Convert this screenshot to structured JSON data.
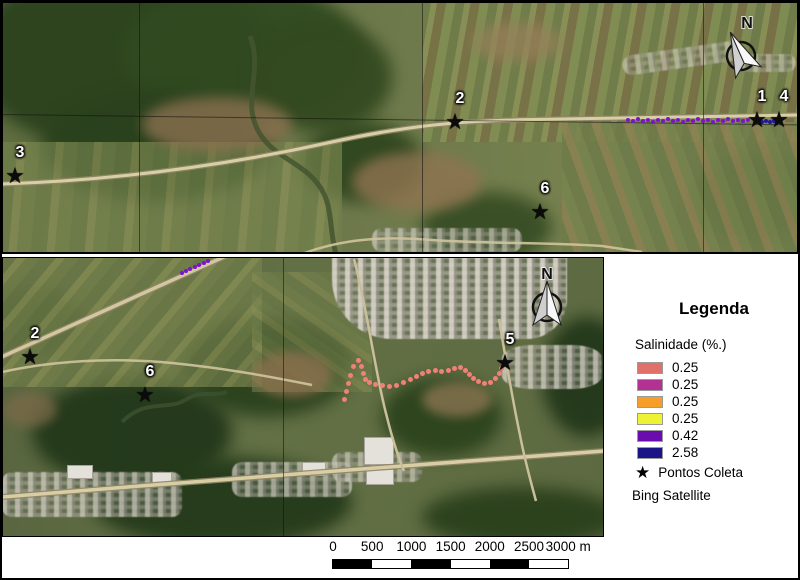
{
  "legend": {
    "title": "Legenda",
    "layer_title": "Salinidade (%.)",
    "classes": [
      {
        "color": "#e0706a",
        "label": "0.25"
      },
      {
        "color": "#b23192",
        "label": "0.25"
      },
      {
        "color": "#f59e29",
        "label": "0.25"
      },
      {
        "color": "#edf232",
        "label": "0.25"
      },
      {
        "color": "#6b0cae",
        "label": "0.42"
      },
      {
        "color": "#1a1487",
        "label": "2.58"
      }
    ],
    "points_symbol": "★",
    "points_label": "Pontos Coleta",
    "basemap_label": "Bing Satellite"
  },
  "north_arrow_label": "N",
  "scalebar": {
    "labels": [
      "0",
      "500",
      "1000",
      "1500",
      "2000",
      "2500",
      "3000 m"
    ],
    "segment_px": 39.2,
    "segment_colors": [
      "#000000",
      "#ffffff",
      "#000000",
      "#ffffff",
      "#000000",
      "#ffffff"
    ]
  },
  "maps": [
    {
      "name": "overview-map",
      "stations": [
        {
          "label": "3",
          "x": 13,
          "y": 174
        },
        {
          "label": "2",
          "x": 453,
          "y": 120
        },
        {
          "label": "6",
          "x": 538,
          "y": 210
        },
        {
          "label": "1",
          "x": 755,
          "y": 118
        },
        {
          "label": "4",
          "x": 777,
          "y": 118
        }
      ],
      "trails": [
        {
          "name": "salinity-042-points",
          "color": "#7d13cc",
          "size": 4,
          "points": [
            [
              626,
              118
            ],
            [
              631,
              119
            ],
            [
              636,
              117
            ],
            [
              641,
              119
            ],
            [
              646,
              118
            ],
            [
              651,
              120
            ],
            [
              656,
              118
            ],
            [
              661,
              119
            ],
            [
              666,
              117
            ],
            [
              671,
              119
            ],
            [
              676,
              118
            ],
            [
              681,
              120
            ],
            [
              686,
              118
            ],
            [
              691,
              119
            ],
            [
              696,
              117
            ],
            [
              701,
              119
            ],
            [
              706,
              118
            ],
            [
              711,
              120
            ],
            [
              716,
              118
            ],
            [
              721,
              119
            ],
            [
              726,
              117
            ],
            [
              731,
              119
            ],
            [
              736,
              118
            ],
            [
              741,
              119
            ],
            [
              746,
              118
            ]
          ]
        },
        {
          "name": "salinity-258-points",
          "color": "#2016a0",
          "size": 4,
          "points": [
            [
              756,
              119
            ],
            [
              760,
              120
            ],
            [
              764,
              119
            ],
            [
              768,
              120
            ],
            [
              772,
              119
            ]
          ]
        }
      ]
    },
    {
      "name": "detail-map",
      "stations": [
        {
          "label": "2",
          "x": 28,
          "y": 100
        },
        {
          "label": "6",
          "x": 143,
          "y": 138
        },
        {
          "label": "5",
          "x": 503,
          "y": 106
        }
      ],
      "trails": [
        {
          "name": "salinity-025-points",
          "color": "#f08177",
          "size": 5,
          "points": [
            [
              342,
              142
            ],
            [
              344,
              134
            ],
            [
              346,
              126
            ],
            [
              348,
              118
            ],
            [
              351,
              109
            ],
            [
              356,
              103
            ],
            [
              359,
              109
            ],
            [
              361,
              116
            ],
            [
              363,
              122
            ],
            [
              367,
              125
            ],
            [
              373,
              127
            ],
            [
              380,
              128
            ],
            [
              387,
              129
            ],
            [
              394,
              128
            ],
            [
              401,
              125
            ],
            [
              408,
              122
            ],
            [
              414,
              119
            ],
            [
              420,
              116
            ],
            [
              426,
              114
            ],
            [
              433,
              113
            ],
            [
              439,
              114
            ],
            [
              446,
              113
            ],
            [
              452,
              111
            ],
            [
              458,
              110
            ],
            [
              463,
              113
            ],
            [
              467,
              117
            ],
            [
              471,
              121
            ],
            [
              476,
              124
            ],
            [
              482,
              126
            ],
            [
              488,
              125
            ],
            [
              493,
              121
            ],
            [
              497,
              116
            ],
            [
              499,
              111
            ],
            [
              501,
              107
            ]
          ]
        },
        {
          "name": "salinity-042-points",
          "color": "#7d13cc",
          "size": 4,
          "points": [
            [
              180,
              16
            ],
            [
              184,
              14
            ],
            [
              188,
              12
            ],
            [
              193,
              10
            ],
            [
              197,
              8
            ],
            [
              202,
              6
            ],
            [
              206,
              4
            ]
          ]
        }
      ]
    }
  ]
}
